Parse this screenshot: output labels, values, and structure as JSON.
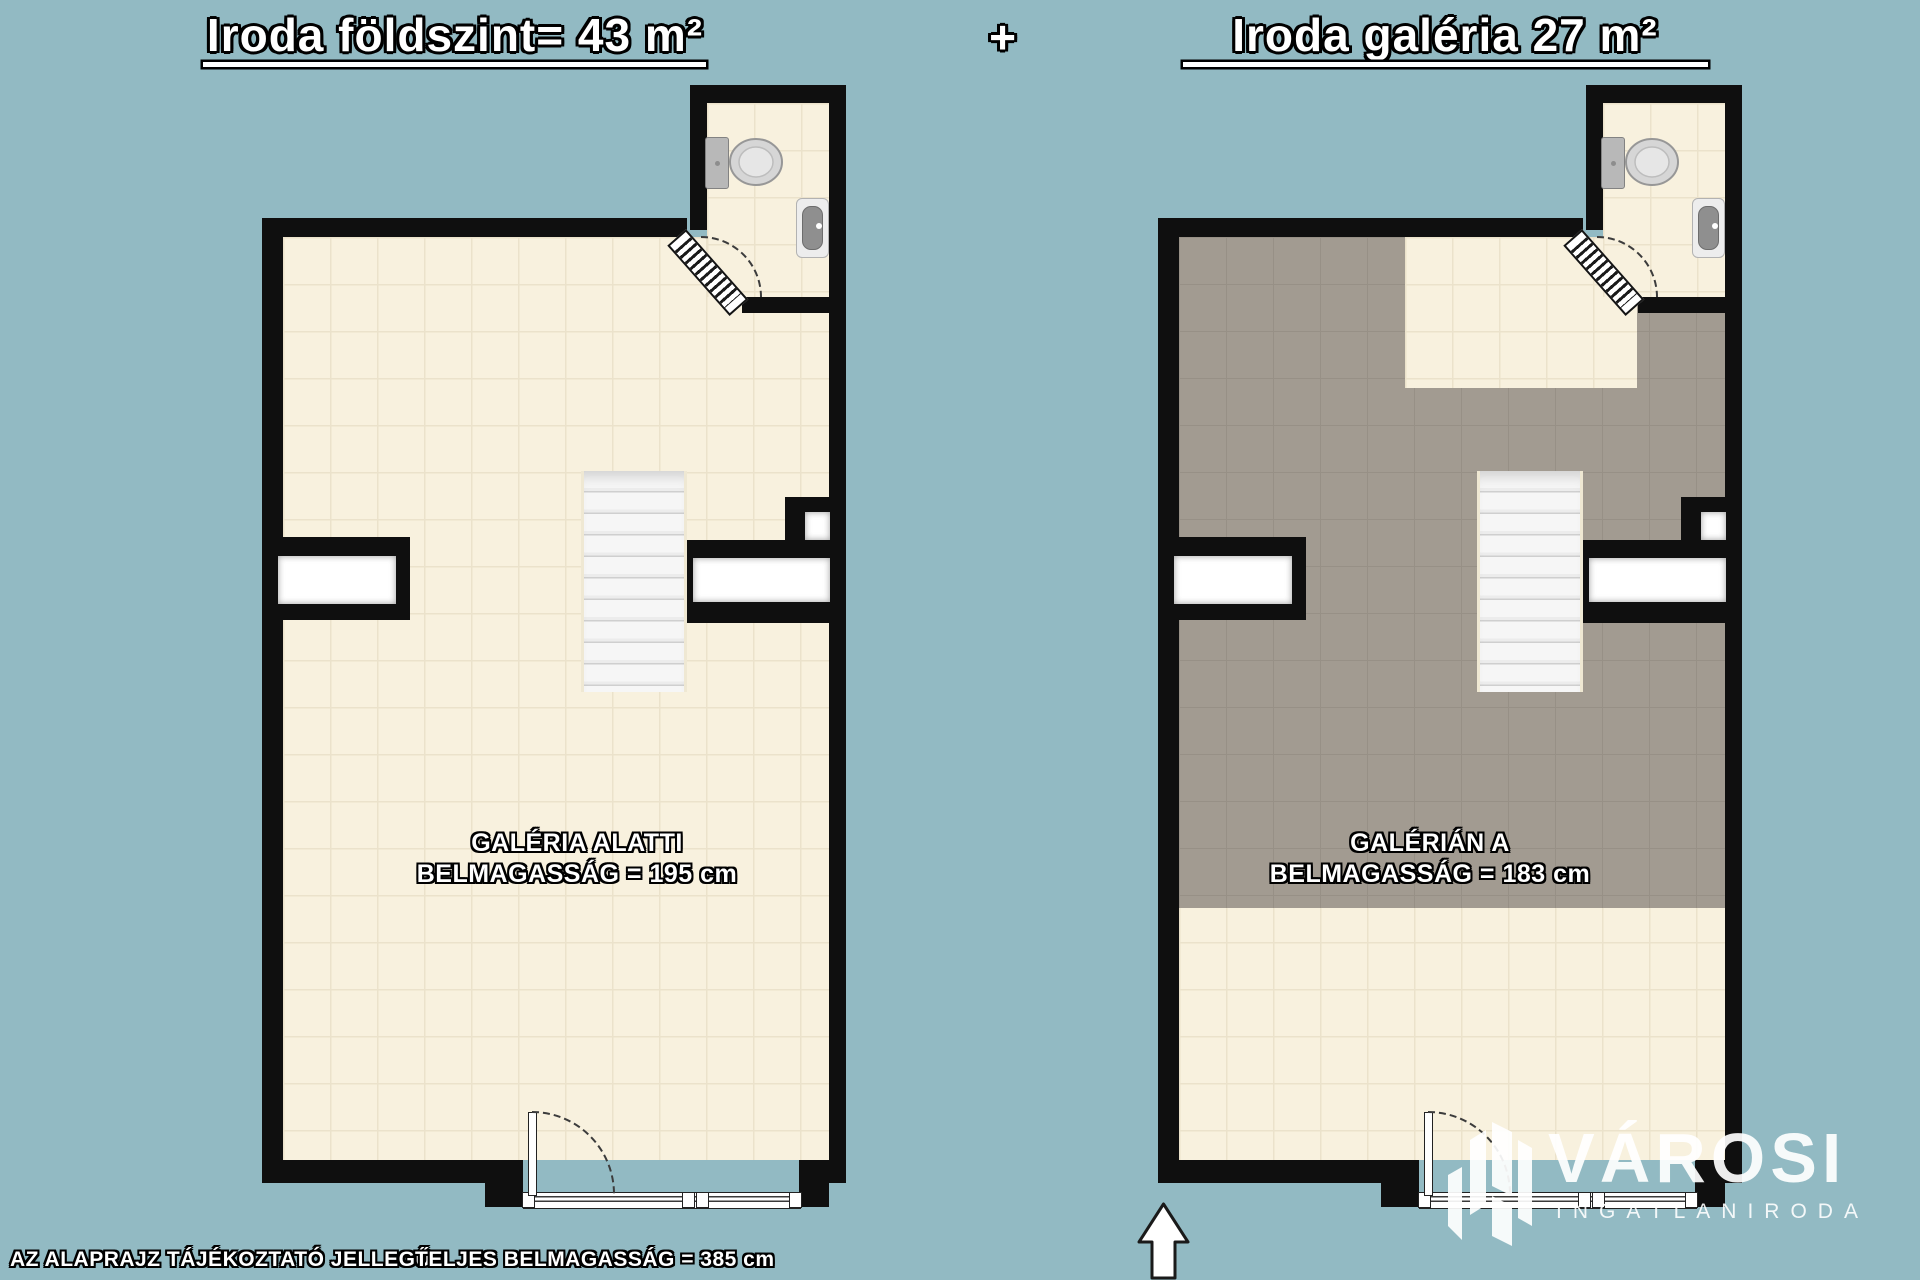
{
  "header": {
    "title_left": "Iroda földszint= 43 m²",
    "plus": "+",
    "title_right": "Iroda galéria 27 m²"
  },
  "plans": {
    "left": {
      "label_line1": "GALÉRIA ALATTI",
      "label_line2": "BELMAGASSÁG = 195 cm"
    },
    "right": {
      "label_line1": "GALÉRIÁN A",
      "label_line2": "BELMAGASSÁG = 183 cm"
    }
  },
  "footer": {
    "note": "AZ ALAPRAJZ TÁJÉKOZTATÓ JELLEGŰ",
    "total_height": "TELJES BELMAGASSÁG = 385 cm"
  },
  "watermark": {
    "brand": "VÁROSI",
    "subtitle": "INGATLANIRODA"
  },
  "icons": {
    "toilet": "toilet-icon",
    "sink": "sink-icon",
    "stairs": "stairs-icon",
    "door_swing": "door-arc-icon",
    "north_arrow": "north-arrow-icon",
    "brand_logo": "brand-logo-icon"
  },
  "colors": {
    "background": "#92bac3",
    "wall": "#0f0f0f",
    "floor_cream": "#f8f1de",
    "floor_gray": "#a29b91",
    "window": "#ffffff",
    "text_fill": "#ffffff",
    "text_outline": "#000000"
  }
}
